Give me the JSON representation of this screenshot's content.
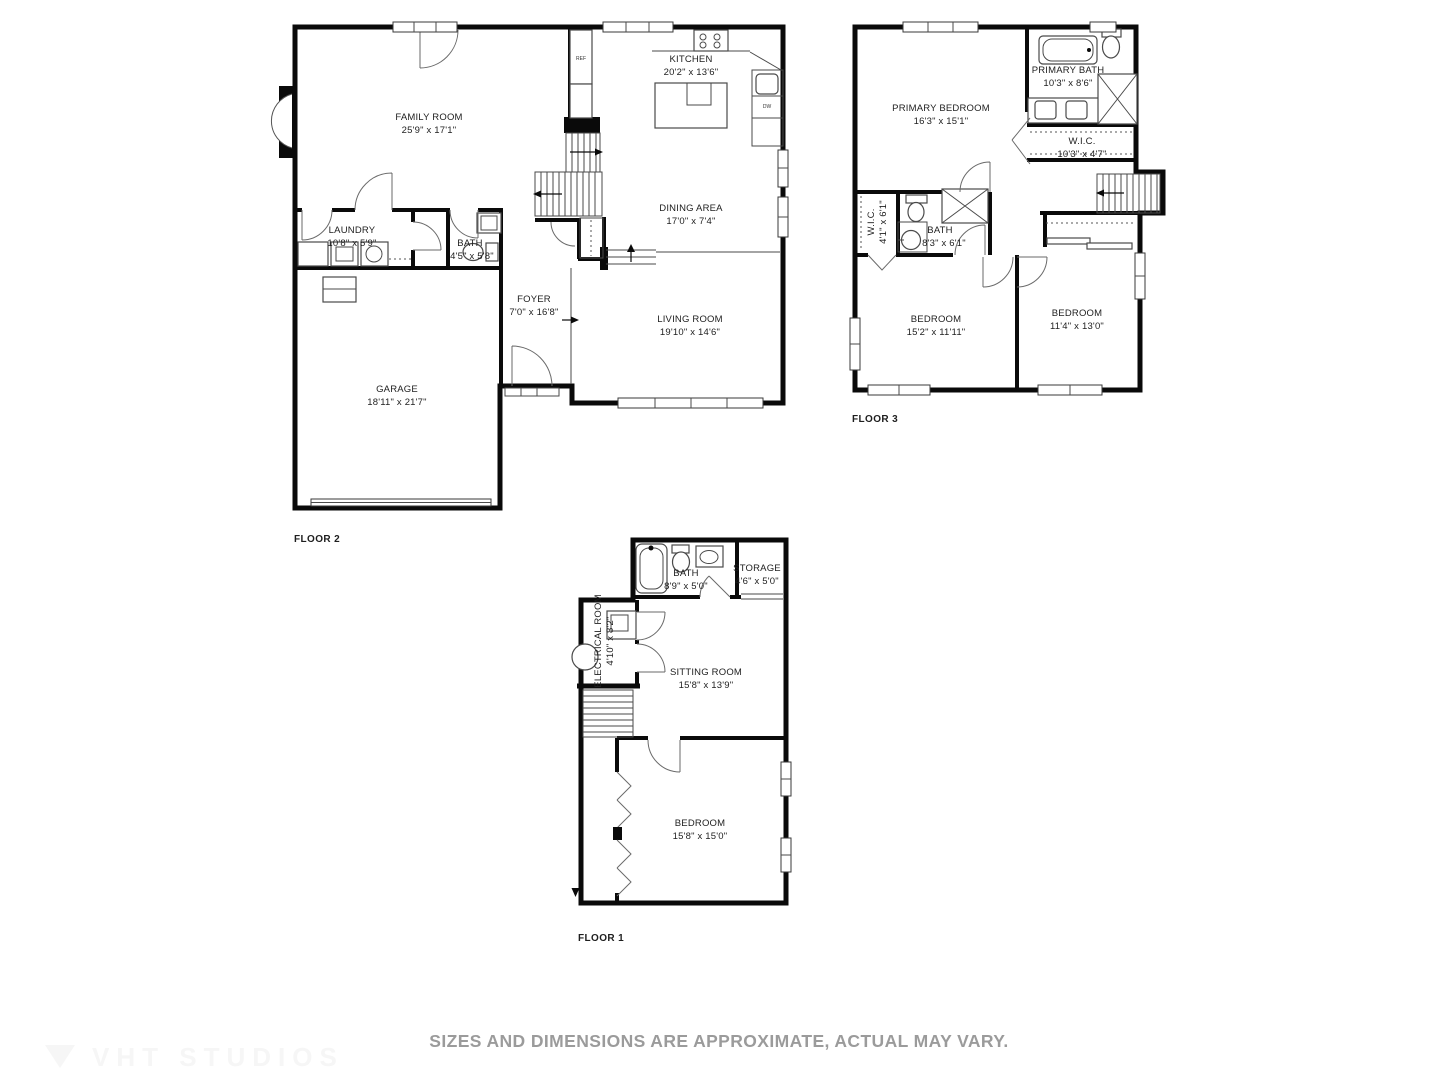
{
  "meta": {
    "disclaimer": "SIZES AND DIMENSIONS ARE APPROXIMATE, ACTUAL MAY VARY.",
    "watermark": "VHT STUDIOS",
    "colors": {
      "wall": "#0a0a0a",
      "thin_line": "#4a4a4a",
      "label": "#1e1e1e",
      "disclaimer": "#9b9b9b"
    }
  },
  "floor2": {
    "label": "FLOOR 2",
    "rooms": {
      "family": {
        "name": "FAMILY ROOM",
        "dims": "25'9\" x 17'1\""
      },
      "kitchen": {
        "name": "KITCHEN",
        "dims": "20'2\" x 13'6\""
      },
      "dining": {
        "name": "DINING AREA",
        "dims": "17'0\" x 7'4\""
      },
      "living": {
        "name": "LIVING ROOM",
        "dims": "19'10\" x 14'6\""
      },
      "foyer": {
        "name": "FOYER",
        "dims": "7'0\" x 16'8\""
      },
      "laundry": {
        "name": "LAUNDRY",
        "dims": "10'8\" x 5'9\""
      },
      "bath": {
        "name": "BATH",
        "dims": "4'5\" x 5'8\""
      },
      "garage": {
        "name": "GARAGE",
        "dims": "18'11\" x 21'7\""
      }
    },
    "fixtures": {
      "ref": "REF",
      "dw": "DW"
    }
  },
  "floor3": {
    "label": "FLOOR 3",
    "rooms": {
      "primary_bedroom": {
        "name": "PRIMARY BEDROOM",
        "dims": "16'3\" x 15'1\""
      },
      "primary_bath": {
        "name": "PRIMARY BATH",
        "dims": "10'3\" x 8'6\""
      },
      "wic": {
        "name": "W.I.C.",
        "dims": "10'3\" x 4'7\""
      },
      "wic2": {
        "name": "W.I.C.",
        "dims": "4'1\" x 6'1\""
      },
      "bath": {
        "name": "BATH",
        "dims": "8'3\" x 6'1\""
      },
      "bedroom1": {
        "name": "BEDROOM",
        "dims": "15'2\" x 11'11\""
      },
      "bedroom2": {
        "name": "BEDROOM",
        "dims": "11'4\" x 13'0\""
      }
    }
  },
  "floor1": {
    "label": "FLOOR 1",
    "rooms": {
      "bath": {
        "name": "BATH",
        "dims": "8'9\" x 5'0\""
      },
      "storage": {
        "name": "STORAGE",
        "dims": "4'6\" x 5'0\""
      },
      "electrical": {
        "name": "ELECTRICAL ROOM",
        "dims": "4'10\" x 8'2\""
      },
      "sitting": {
        "name": "SITTING ROOM",
        "dims": "15'8\" x 13'9\""
      },
      "bedroom": {
        "name": "BEDROOM",
        "dims": "15'8\" x 15'0\""
      }
    }
  }
}
